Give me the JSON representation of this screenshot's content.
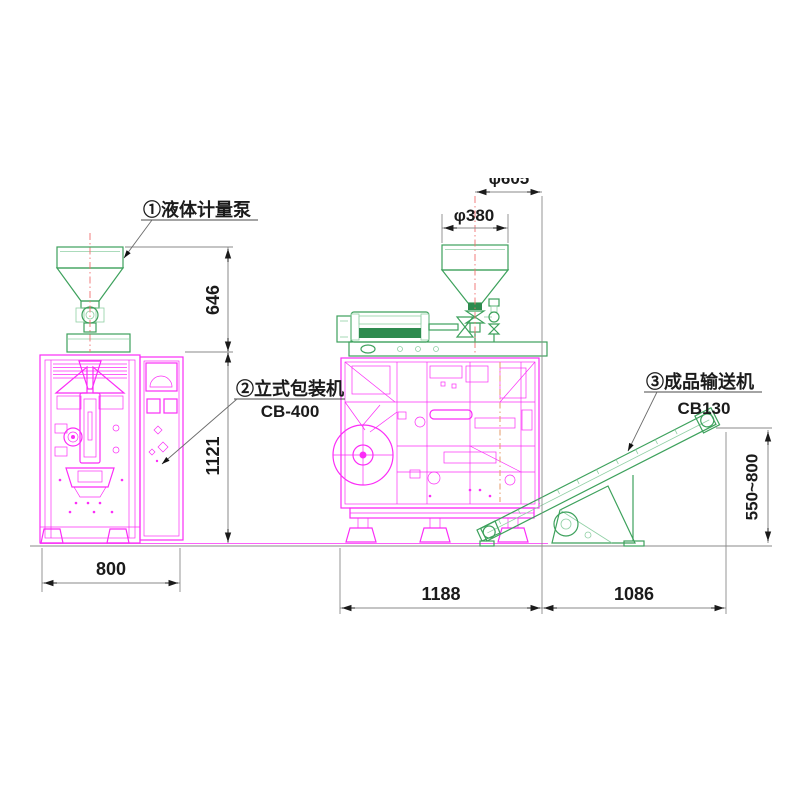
{
  "drawing": {
    "type": "engineering-layout-drawing",
    "description": "Vertical packaging machine line: liquid metering pump, vertical packing machine CB-400, finished product conveyor CB130"
  },
  "labels": {
    "pump_label": "①液体计量泵",
    "packer_label": "②立式包装机",
    "packer_model": "CB-400",
    "conveyor_label": "③成品输送机",
    "conveyor_model": "CB130"
  },
  "dimensions": {
    "hopper_height": "646",
    "machine_height": "1121",
    "machine_width": "800",
    "packer_length": "1188",
    "conveyor_span": "1086",
    "discharge_height": "550~800",
    "hopper_diameter": "φ380",
    "top_clipped_dim": "φ605"
  },
  "colors": {
    "magenta": "#fb2df7",
    "green": "#3da15c",
    "green_dark": "#2e8b4f",
    "green_light": "#8fcfa4",
    "dim_line": "#8a8a8a",
    "text": "#1b1b1b",
    "leader": "#6b6b6b",
    "centerline_red": "#f07070",
    "centerline_orange": "#e6a476"
  }
}
